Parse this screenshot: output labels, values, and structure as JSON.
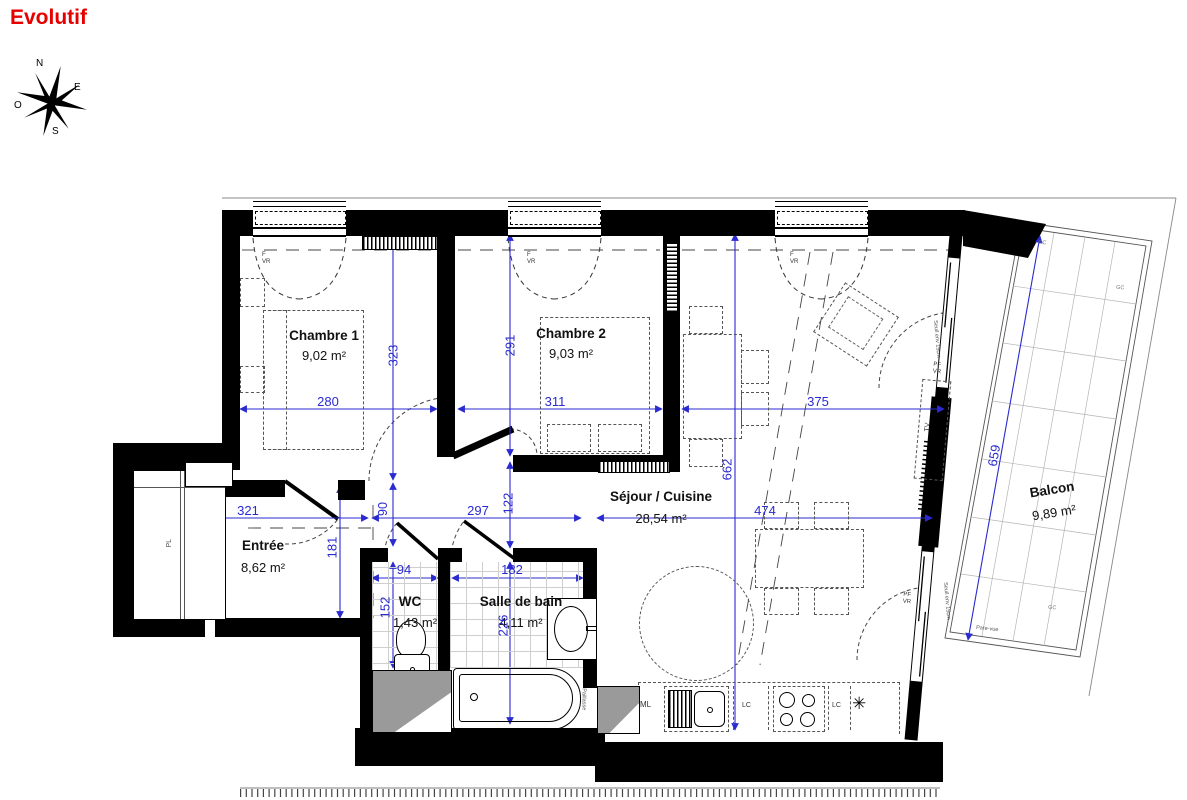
{
  "title": "Evolutif",
  "compass": {
    "n": "N",
    "e": "E",
    "s": "S",
    "o": "O"
  },
  "rooms": {
    "chambre1": {
      "name": "Chambre 1",
      "area": "9,02 m²"
    },
    "chambre2": {
      "name": "Chambre 2",
      "area": "9,03 m²"
    },
    "sejour": {
      "name": "Séjour / Cuisine",
      "area": "28,54 m²"
    },
    "entree": {
      "name": "Entrée",
      "area": "8,62 m²"
    },
    "wc": {
      "name": "WC",
      "area": "1,43 m²"
    },
    "sdb": {
      "name": "Salle de bain",
      "area": "4,11 m²"
    },
    "balcon": {
      "name": "Balcon",
      "area": "9,89 m²"
    }
  },
  "dimensions": {
    "ch1_width": "280",
    "ch1_height": "323",
    "ch2_width": "311",
    "ch2_height": "291",
    "sej_width": "375",
    "sej_width2": "474",
    "sej_height": "662",
    "ent_width": "321",
    "ent_height": "181",
    "cor_gap": "90",
    "cor_width": "297",
    "cor_height": "122",
    "wc_width": "94",
    "wc_height": "152",
    "sdb_width": "182",
    "sdb_height": "226",
    "balc_length": "659"
  },
  "labels": {
    "f": "F",
    "vr": "VR",
    "pf": "PF",
    "pl": "PL",
    "ml": "ML",
    "lc": "LC",
    "tv": "TV",
    "gc": "GC",
    "paillasse": "Paillasse",
    "seuil": "Seuil env 15cm",
    "pare_vue": "Pare-vue",
    "fridge_star": "✳"
  },
  "colors": {
    "dimension_blue": "#2a2ad0",
    "title_red": "#e60000"
  }
}
